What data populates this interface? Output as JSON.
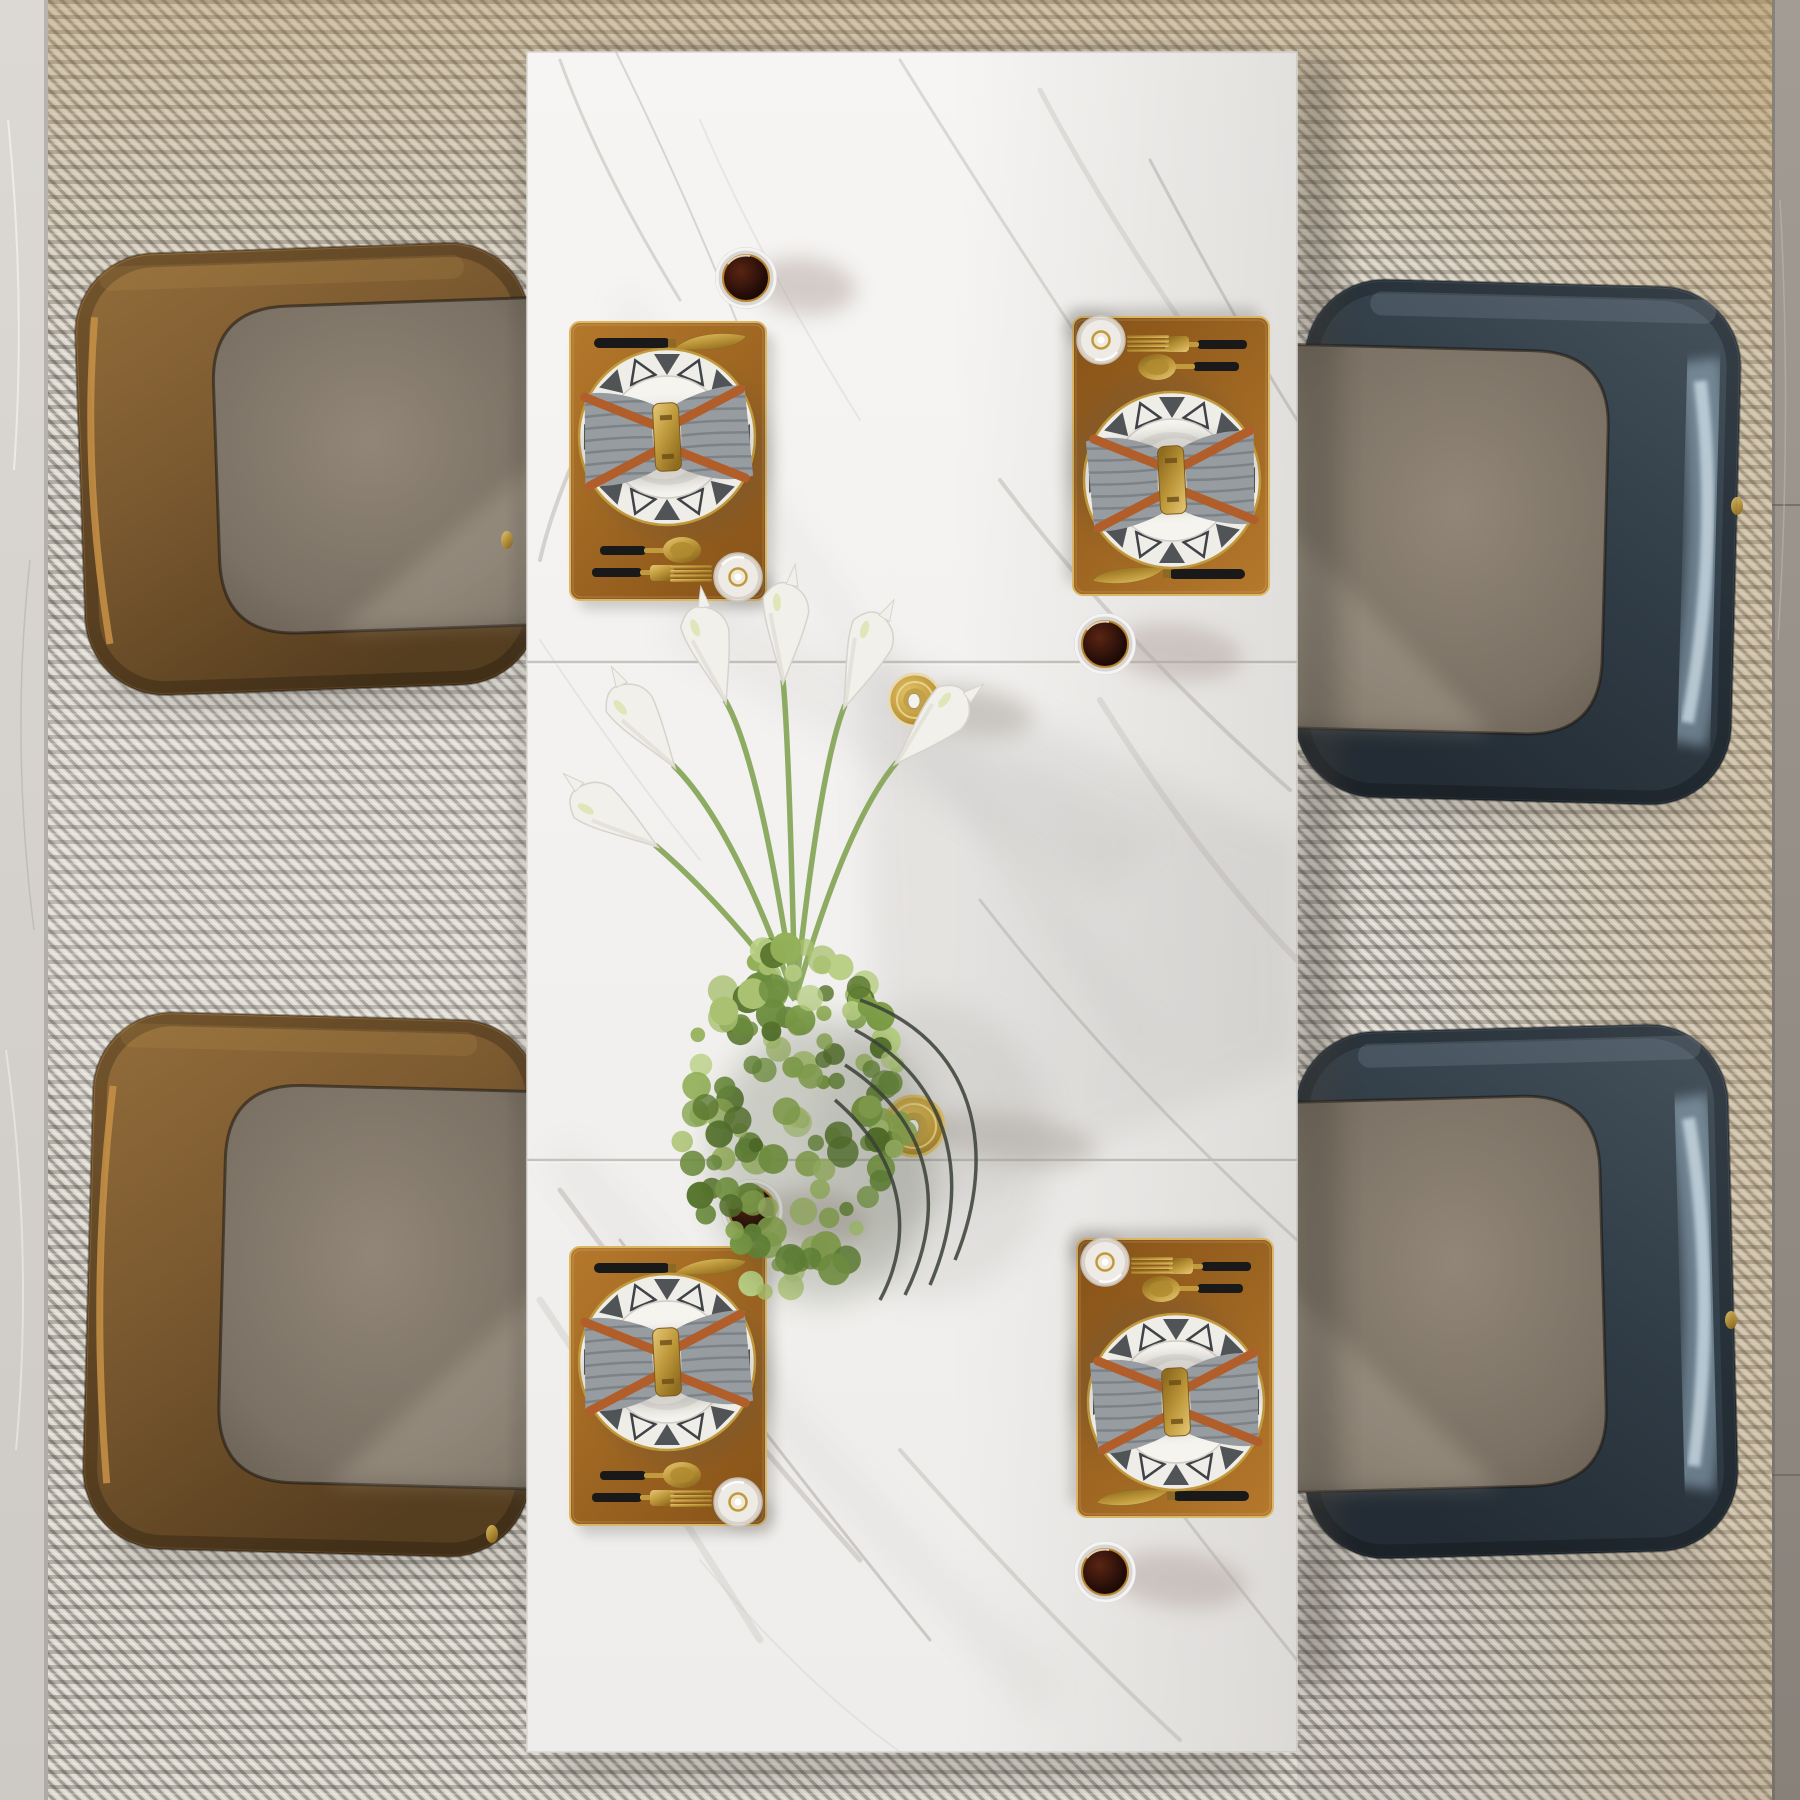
{
  "meta": {
    "description": "Top-down photorealistic render of a modern dining set: white marble rectangular table on a woven gray rug, two brown leather chairs on the left, two navy-blue leather chairs on the right, four tan placemats with patterned plates, gray bow-tied napkins, gold cutlery, glasses of dark drink, white calla lilies with green hydrangea centerpiece and gold candle holders.",
    "canvas_w": 1800,
    "canvas_h": 1800
  },
  "palette": {
    "rug_base": "#d9d5cc",
    "rug_dark": "#474039",
    "rug_stripe": "#35312c",
    "rug_light": "#fffdf8",
    "rug_warm": "#b08e55",
    "floor_left_a": "#dcd9d5",
    "floor_left_b": "#cdc9c4",
    "floor_right_a": "#a29c94",
    "floor_right_b": "#87817a",
    "table_a": "#f6f5f3",
    "table_b": "#efedeb",
    "vein_a": "#b9b5b0",
    "vein_b": "#a8a4a0",
    "vein_soft": "#cfccc8",
    "seam": "#c6c3bf",
    "shadow": "#47423b",
    "mat_a": "#b5792c",
    "mat_b": "#8a5519",
    "mat_trim": "#d9b765",
    "gold_a": "#e6c878",
    "gold_b": "#c09a3c",
    "gold_c": "#8f6c1f",
    "handle_black": "#191919",
    "plate_rim": "#efede7",
    "plate_inner": "#f6f4ef",
    "plate_pattern": "#3f4246",
    "napkin_gray": "#979ca0",
    "napkin_line": "#74797d",
    "strap_orange": "#b15e2b",
    "liquid_a": "#5a2413",
    "liquid_b": "#1f0b07",
    "glass_ring": "#d8d6d3",
    "glass_shadow": "#b3a4a1",
    "brown_shell_a": "#936d3b",
    "brown_shell_b": "#7c5a30",
    "brown_shell_c": "#553d1f",
    "brown_piping": "#c89246",
    "blue_shell_a": "#46525c",
    "blue_shell_b": "#313d47",
    "blue_shell_c": "#232c34",
    "blue_ice_a": "#9db6c6",
    "blue_ice_b": "#d5e5ef",
    "seat_a": "#918678",
    "seat_b": "#7b7164",
    "seat_c": "#675e52",
    "stem_green": "#88a65b",
    "lily_white": "#f2f0eb",
    "lily_edge": "#d6d3cc",
    "spadix": "#dfe6b8",
    "wire": "#3a3f36",
    "leaf_palette": [
      "#a9c170",
      "#93b058",
      "#7fa04a",
      "#6b8c3e",
      "#59762f",
      "#b9cf85"
    ]
  },
  "rug": {
    "x": 48,
    "y": 0,
    "w": 1724,
    "h": 1800
  },
  "floor": {
    "left": {
      "x": 0,
      "y": 0,
      "w": 48,
      "h": 1800
    },
    "right": {
      "x": 1772,
      "y": 0,
      "w": 28,
      "h": 1800,
      "seams": [
        505,
        1475
      ]
    }
  },
  "table": {
    "x": 527,
    "y": 52,
    "w": 770,
    "h": 1700,
    "seams": [
      662,
      1160
    ],
    "veins": [
      {
        "d": "M560,60 Q600,170 680,300",
        "w": 3,
        "o": 0.5,
        "c": "vein_a"
      },
      {
        "d": "M610,40 Q690,200 760,380",
        "w": 2,
        "o": 0.4,
        "c": "vein_b"
      },
      {
        "d": "M640,330 Q560,470 540,560",
        "w": 4,
        "o": 0.55,
        "c": "vein_a"
      },
      {
        "d": "M700,120 Q760,260 860,420",
        "w": 2,
        "o": 0.35,
        "c": "vein_soft"
      },
      {
        "d": "M900,60 Q1000,220 1120,400",
        "w": 3,
        "o": 0.45,
        "c": "vein_a"
      },
      {
        "d": "M1040,90 Q1130,260 1260,430",
        "w": 5,
        "o": 0.5,
        "c": "vein_soft"
      },
      {
        "d": "M1150,160 Q1240,330 1297,420",
        "w": 3,
        "o": 0.45,
        "c": "vein_b"
      },
      {
        "d": "M540,640 Q620,760 700,860",
        "w": 2,
        "o": 0.35,
        "c": "vein_soft"
      },
      {
        "d": "M1000,480 Q1120,640 1290,790",
        "w": 4,
        "o": 0.5,
        "c": "vein_a"
      },
      {
        "d": "M1100,700 Q1200,860 1297,960",
        "w": 6,
        "o": 0.5,
        "c": "vein_soft"
      },
      {
        "d": "M980,900 Q1120,1080 1297,1240",
        "w": 3,
        "o": 0.4,
        "c": "vein_b"
      },
      {
        "d": "M560,1190 Q700,1380 860,1560",
        "w": 5,
        "o": 0.5,
        "c": "vein_a"
      },
      {
        "d": "M540,1300 Q660,1480 760,1640",
        "w": 7,
        "o": 0.45,
        "c": "vein_soft"
      },
      {
        "d": "M620,1240 Q760,1430 930,1640",
        "w": 3,
        "o": 0.5,
        "c": "vein_b"
      },
      {
        "d": "M900,1450 Q1050,1620 1180,1740",
        "w": 4,
        "o": 0.45,
        "c": "vein_a"
      },
      {
        "d": "M1080,1380 Q1200,1540 1297,1660",
        "w": 3,
        "o": 0.4,
        "c": "vein_b"
      },
      {
        "d": "M700,1560 Q800,1680 900,1752",
        "w": 2,
        "o": 0.35,
        "c": "vein_soft"
      }
    ]
  },
  "chairs": [
    {
      "id": "top-left",
      "variant": "brown",
      "x": 80,
      "y": 248,
      "w": 455,
      "h": 442,
      "facing": "right",
      "rot": -2,
      "foot": {
        "x": 507,
        "y": 540
      }
    },
    {
      "id": "bottom-left",
      "variant": "brown",
      "x": 88,
      "y": 1016,
      "w": 447,
      "h": 537,
      "facing": "right",
      "rot": 1.5,
      "foot": {
        "x": 492,
        "y": 1534
      }
    },
    {
      "id": "top-right",
      "variant": "blue",
      "x": 1300,
      "y": 283,
      "w": 436,
      "h": 518,
      "facing": "left",
      "rot": 1.5,
      "foot": {
        "x": 1737,
        "y": 506
      }
    },
    {
      "id": "bottom-right",
      "variant": "blue",
      "x": 1300,
      "y": 1028,
      "w": 433,
      "h": 527,
      "facing": "left",
      "rot": -1.5,
      "foot": {
        "x": 1731,
        "y": 1320
      }
    }
  ],
  "setting_size": {
    "w": 196,
    "h": 278
  },
  "settings": [
    {
      "id": "top-left",
      "x": 570,
      "y": 322,
      "orient": "left"
    },
    {
      "id": "top-right",
      "x": 1073,
      "y": 317,
      "orient": "right"
    },
    {
      "id": "bottom-left",
      "x": 570,
      "y": 1247,
      "orient": "left"
    },
    {
      "id": "bottom-right",
      "x": 1077,
      "y": 1239,
      "orient": "right"
    }
  ],
  "drink_glasses": [
    {
      "id": "1",
      "x": 746,
      "y": 278,
      "sdx": 58,
      "srx": 52
    },
    {
      "id": "2",
      "x": 1105,
      "y": 644,
      "sdx": 72,
      "srx": 66
    },
    {
      "id": "3",
      "x": 752,
      "y": 1210,
      "sdx": 62,
      "srx": 56
    },
    {
      "id": "4",
      "x": 1105,
      "y": 1572,
      "sdx": 74,
      "srx": 68
    }
  ],
  "candles": [
    {
      "id": "top",
      "x": 915,
      "y": 700,
      "r": 26,
      "sdx": 60,
      "srx": 58,
      "lip": "#e7d9b2"
    },
    {
      "id": "bottom",
      "x": 914,
      "y": 1126,
      "r": 30,
      "sdx": 96,
      "srx": 88,
      "lip": "#d9bd6d"
    }
  ],
  "flowers": {
    "stem_origin": {
      "x": 795,
      "y": 1000
    },
    "lilies": [
      {
        "bx": 655,
        "by": 845,
        "a": -55
      },
      {
        "bx": 673,
        "by": 765,
        "a": -35
      },
      {
        "bx": 725,
        "by": 700,
        "a": -15
      },
      {
        "bx": 783,
        "by": 680,
        "a": 3
      },
      {
        "bx": 845,
        "by": 705,
        "a": 22
      },
      {
        "bx": 897,
        "by": 762,
        "a": 45
      }
    ],
    "ball": {
      "cx": 793,
      "cy": 1120,
      "rx": 112,
      "ry": 178,
      "leaves": 150
    },
    "wires": [
      "M 855 1030 C 950 1080 975 1180 930 1285",
      "M 845 1065 C 930 1120 950 1205 905 1295",
      "M 860 1000 C 975 1040 1000 1150 955 1260",
      "M 835 1100 C 905 1160 915 1235 880 1300"
    ],
    "shadow_polys": [
      {
        "pts": "860,640 1297,840 1297,1060 880,1240",
        "o": 0.13
      },
      {
        "pts": "700,580 1160,840 1100,900 660,640",
        "o": 0.08
      }
    ]
  }
}
